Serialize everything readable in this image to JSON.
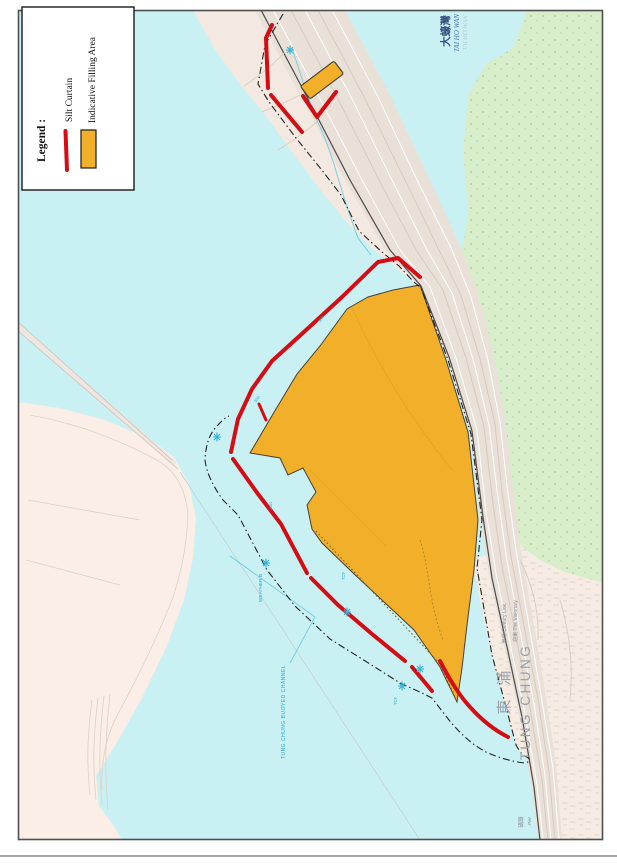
{
  "legend": {
    "title": "Legend :",
    "silt_curtain_label": "Silt Curtain",
    "filling_area_label": "Indicative Filling Area"
  },
  "labels": {
    "tai_ho_wan_zh": "大蠔灣",
    "tai_ho_wan_en": "TAI HO WAN",
    "tai_ho_wan_alt": "TAI HO WAN",
    "tung_chung_zh": "東 涌",
    "tung_chung_en": "TUNG CHUNG",
    "century_link": "東環 Century Link,",
    "the_visionary": "迎東 The Visionary",
    "pier_zh": "碼頭",
    "pier_en": "Pier",
    "weather_buoy": "WEATHER B",
    "buoyed_channel": "TUNG CHUNG BUOYED CHANNEL",
    "dist_300_a": "300",
    "dist_300_b": "300",
    "dist_2002": "2002",
    "tcf_a": "TCF",
    "tcf_b": "TCF"
  },
  "colors": {
    "water": "#c9f1f4",
    "shore_land": "#f3e9e1",
    "urban_land": "#f6ece4",
    "airport_land": "#faeee6",
    "green_hills": "#d8eecb",
    "highway": "#e9e0d8",
    "filling_area": "#f2b02a",
    "silt_curtain": "#d40d14",
    "boundary": "#222222",
    "channel_blue": "#35b3d6",
    "label_grey": "#9aa0a8"
  }
}
